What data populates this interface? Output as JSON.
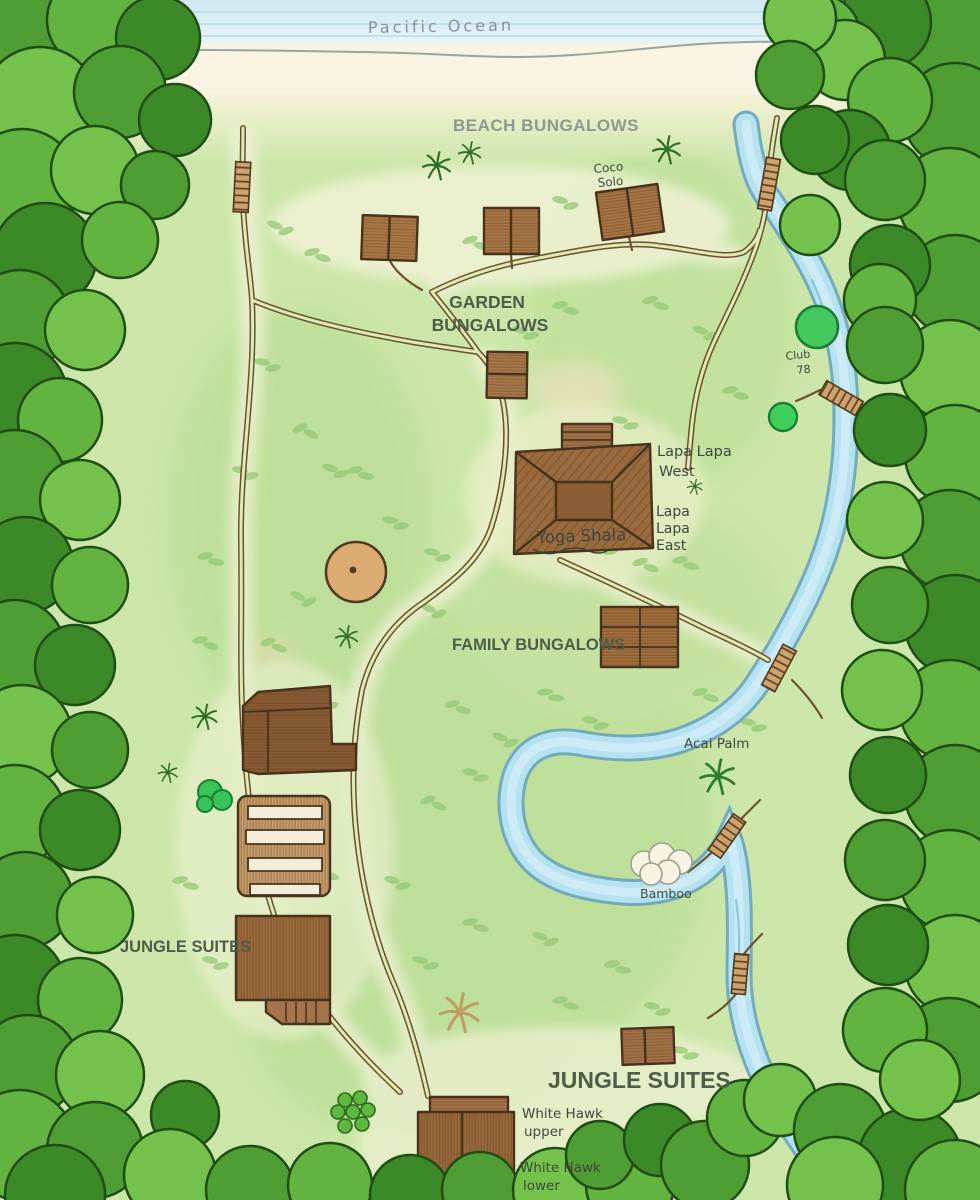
{
  "ocean": {
    "label": "Pacific Ocean"
  },
  "area_labels": {
    "beach_bungalows": "BEACH BUNGALOWS",
    "garden_line1": "GARDEN",
    "garden_line2": "BUNGALOWS",
    "family_bungalows": "FAMILY BUNGALOWS",
    "jungle_suites_west": "JUNGLE SUITES",
    "jungle_suites_south": "JUNGLE SUITES"
  },
  "locations": {
    "coco_solo_line1": "Coco",
    "coco_solo_line2": "Solo",
    "club78_line1": "Club",
    "club78_line2": "78",
    "lapa_west_line1": "Lapa Lapa",
    "lapa_west_line2": "West",
    "lapa_east_line1": "Lapa",
    "lapa_east_line2": "Lapa",
    "lapa_east_line3": "East",
    "yoga_shala": "Yoga Shala",
    "acai_palm": "Acai Palm",
    "bamboo": "Bamboo",
    "white_hawk_upper_line1": "White Hawk",
    "white_hawk_upper_line2": "upper",
    "white_hawk_lower_line1": "White Hawk",
    "white_hawk_lower_line2": "lower"
  },
  "palette": {
    "ocean": "#cfe9f2",
    "sand": "#f8f4e1",
    "meadow": "#cbe6a8",
    "forest": "#4c9a33",
    "river": "#b5e2f0",
    "trail": "#6e4f2e",
    "building": "#a6774a",
    "ink": "#3f473c"
  }
}
